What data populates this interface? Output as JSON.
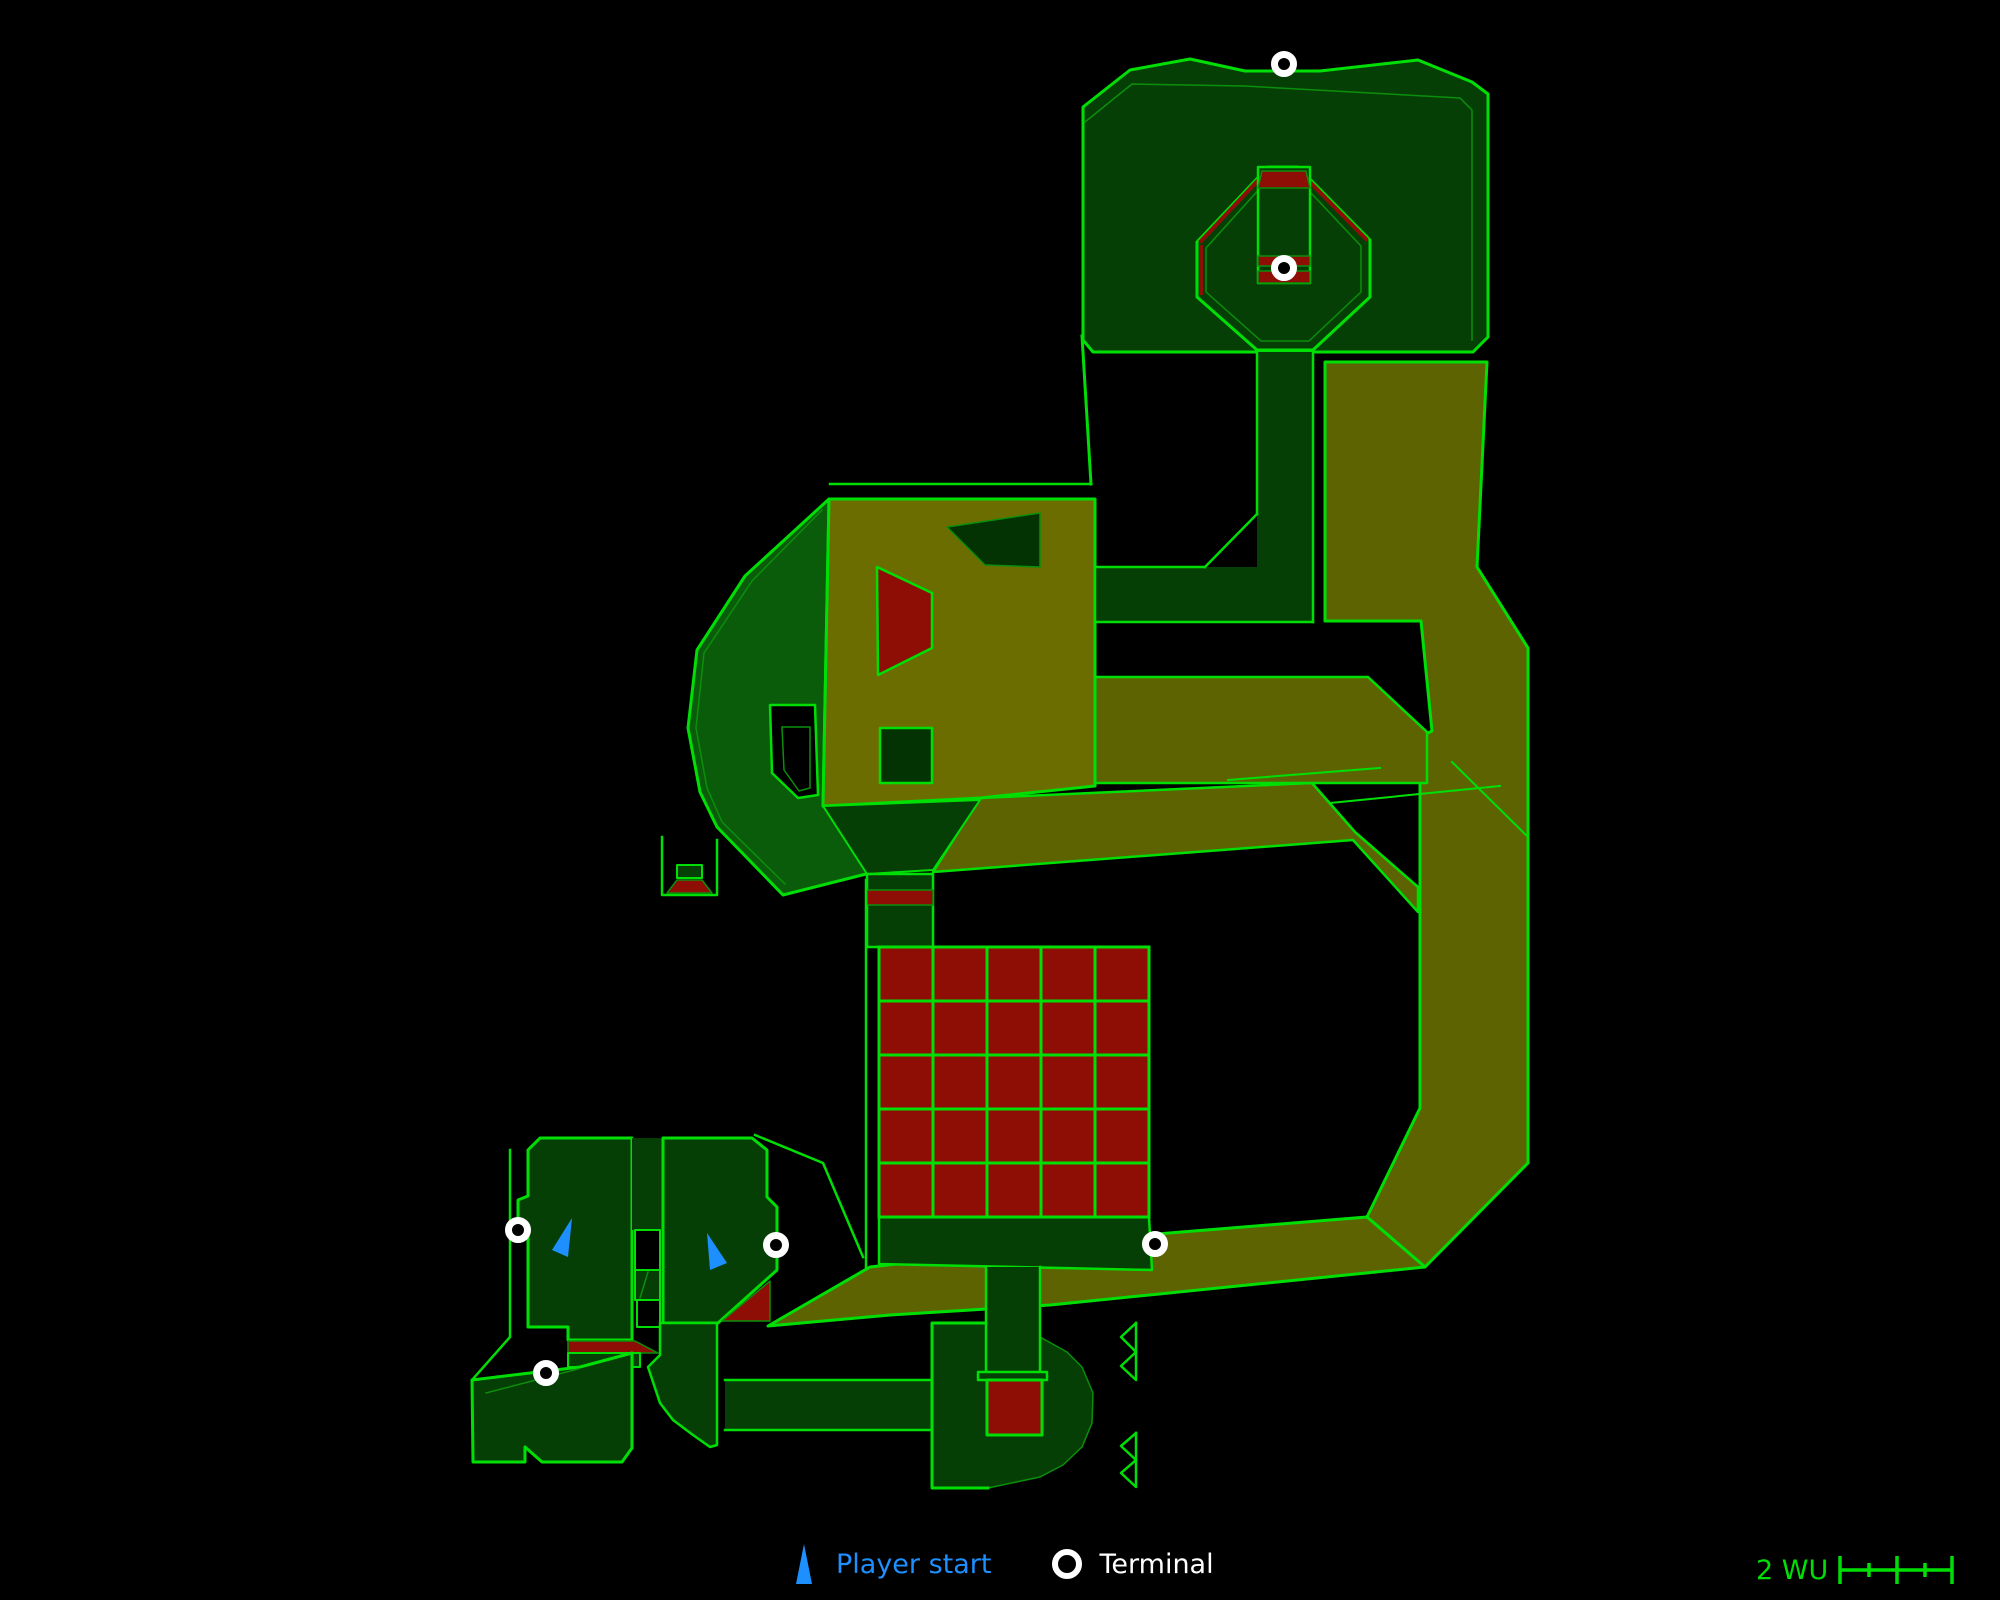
{
  "colors": {
    "background": "#000000",
    "bright": "#00df05",
    "dim": "#0b8f0b",
    "dg": "#063f06",
    "dg2": "#033203",
    "hept": "#0a5c0a",
    "olive": "#6c6d00",
    "olive2": "#5d6300",
    "red": "#8e0e06",
    "player": "#1e8fff",
    "terminal_ring": "#ffffff"
  },
  "legend": {
    "player_start_label": "Player start",
    "terminal_label": "Terminal"
  },
  "scale_bar": {
    "label": "2 WU"
  },
  "map": {
    "width": 2000,
    "height": 1600,
    "shapes": [
      {
        "t": "p",
        "n": "top-block",
        "pts": "1083,107 1130,70 1190,59 1245,71 1320,71 1418,60 1472,82 1488,94 1488,337 1473,352 1093,352 1083,340",
        "f": "dg",
        "s": "bright",
        "w": 3
      },
      {
        "t": "l",
        "n": "top-block-inner-line",
        "pts": "1085,122 1132,84 1244,86 1460,98 1472,110 1472,340",
        "s": "dim",
        "w": 1.5
      },
      {
        "t": "p",
        "n": "right-corridor",
        "pts": "1325,362 1487,362 1477,567 1528,648 1528,1163 1425,1267 1367,1217 1420,1108 1420,737 1432,731 1421,621 1325,621",
        "f": "olive2",
        "s": "bright",
        "w": 3
      },
      {
        "t": "p",
        "n": "lower-diagonal-corridor",
        "pts": "870,1267 1157,1234 1367,1217 1425,1267 1050,1305 890,1315 768,1326",
        "f": "olive2",
        "s": "bright",
        "w": 3
      },
      {
        "t": "p",
        "n": "upper-link-corridor",
        "pts": "980,798 1312,783 1355,832 1418,887 1418,912 1353,840 933,872",
        "f": "olive2",
        "s": "bright",
        "w": 2.5
      },
      {
        "t": "p",
        "n": "east-corridor-fill",
        "pts": "1095,677 1368,677 1427,732 1427,783 1095,783",
        "f": "olive2"
      },
      {
        "t": "l",
        "n": "east-corridor-edges",
        "pts": "1095,677 1368,677 1427,732 1427,783 1095,783",
        "s": "bright",
        "w": 2.5
      },
      {
        "t": "p",
        "n": "heptagon-room",
        "pts": "829,499 745,576 697,650 688,728 700,792 717,827 783,895 870,873 870,806 823,806",
        "f": "hept",
        "s": "bright",
        "w": 3
      },
      {
        "t": "l",
        "n": "heptagon-inner-line",
        "pts": "822,510 752,581 704,653 696,728 707,788 722,822 785,884",
        "s": "dim",
        "w": 1.5
      },
      {
        "t": "p",
        "n": "big-olive-room",
        "pts": "829,499 1095,499 1095,786 980,798 823,806",
        "f": "olive",
        "s": "bright",
        "w": 3
      },
      {
        "t": "p",
        "n": "room-south-wedge",
        "pts": "823,806 980,800 933,870 867,874",
        "f": "dg",
        "s": "bright",
        "w": 2
      },
      {
        "t": "p",
        "n": "room-dark-quad",
        "pts": "947,527 1040,513 1040,567 985,565",
        "f": "dg2",
        "s": "dim",
        "w": 1.5
      },
      {
        "t": "p",
        "n": "room-red-quad",
        "pts": "877,567 932,593 932,648 878,675",
        "f": "red",
        "s": "bright",
        "w": 2.5
      },
      {
        "t": "p",
        "n": "room-dark-square",
        "pts": "880,728 932,728 932,783 880,783",
        "f": "dg2",
        "s": "bright",
        "w": 2.5
      },
      {
        "t": "p",
        "n": "neck-fill",
        "pts": "1257,352 1313,352 1313,622 1257,622",
        "f": "dg"
      },
      {
        "t": "p",
        "n": "cross-strip-fill",
        "pts": "1095,567 1313,567 1313,622 1095,622",
        "f": "dg"
      },
      {
        "t": "l",
        "n": "neck-left-wall",
        "pts": "1257,352 1257,514",
        "s": "bright",
        "w": 2.5
      },
      {
        "t": "l",
        "n": "neck-diag-wall",
        "pts": "1257,514 1205,567",
        "s": "bright",
        "w": 2.5
      },
      {
        "t": "l",
        "n": "strip-top-edge",
        "pts": "1095,567 1205,567",
        "s": "bright",
        "w": 2.5
      },
      {
        "t": "l",
        "n": "strip-bottom-edge",
        "pts": "1095,622 1313,622",
        "s": "bright",
        "w": 2.5
      },
      {
        "t": "l",
        "n": "strip-left-edge",
        "pts": "1095,567 1095,622",
        "s": "bright",
        "w": 2.5
      },
      {
        "t": "l",
        "n": "neck-right-wall",
        "pts": "1313,352 1313,622",
        "s": "bright",
        "w": 2.5
      },
      {
        "t": "l",
        "n": "leg-slant-wall",
        "pts": "1082,336 1091,484",
        "s": "bright",
        "w": 3
      },
      {
        "t": "l",
        "n": "room-top-outer-line",
        "pts": "830,484 1091,484",
        "s": "bright",
        "w": 2.5
      },
      {
        "t": "p",
        "n": "octagon",
        "pts": "1268,167 1298,167 1370,240 1370,297 1313,350 1257,350 1197,297 1197,242",
        "f": "dg",
        "s": "bright",
        "w": 3
      },
      {
        "t": "l",
        "n": "octagon-inner-line",
        "pts": "1271,176 1295,176 1361,246 1361,292 1309,341 1261,341 1206,292 1206,248 1271,176",
        "s": "dim",
        "w": 1.5
      },
      {
        "t": "l",
        "n": "octagon-red-nw",
        "pts": "1264,174 1201,241",
        "s": "red",
        "w": 4
      },
      {
        "t": "l",
        "n": "octagon-red-w",
        "pts": "1201,247 1201,293",
        "s": "red",
        "w": 4
      },
      {
        "t": "l",
        "n": "octagon-red-ne",
        "pts": "1302,174 1366,239",
        "s": "red",
        "w": 4
      },
      {
        "t": "p",
        "n": "octagon-shaft",
        "pts": "1258,167 1310,167 1310,283 1258,283",
        "f": "dg",
        "s": "bright",
        "w": 2.5
      },
      {
        "t": "p",
        "n": "shaft-red-top",
        "pts": "1262,171 1306,171 1310,188 1258,188",
        "f": "red",
        "s": "dim",
        "w": 1.5
      },
      {
        "t": "p",
        "n": "shaft-red-band1",
        "pts": "1258,256 1310,256 1310,266 1258,266",
        "f": "red",
        "s": "dim",
        "w": 1.5
      },
      {
        "t": "p",
        "n": "shaft-red-band2",
        "pts": "1258,271 1310,271 1310,283 1258,283",
        "f": "red",
        "s": "dim",
        "w": 1.5
      },
      {
        "t": "l",
        "n": "cross-line-a",
        "pts": "1228,780 1380,768",
        "s": "bright",
        "w": 2
      },
      {
        "t": "l",
        "n": "cross-line-b",
        "pts": "1452,762 1528,837",
        "s": "bright",
        "w": 2
      },
      {
        "t": "l",
        "n": "cross-line-c",
        "pts": "1330,803 1500,786",
        "s": "bright",
        "w": 2
      },
      {
        "t": "p",
        "n": "plug-box",
        "pts": "677,865 702,865 702,878 677,878",
        "f": "dg",
        "s": "bright",
        "w": 2
      },
      {
        "t": "p",
        "n": "plug-red",
        "pts": "677,880 702,880 712,893 667,893",
        "f": "red",
        "s": "dim",
        "w": 1.5
      },
      {
        "t": "l",
        "n": "plug-walls",
        "pts": "662,837 662,895 717,895 717,840",
        "s": "bright",
        "w": 2.5
      },
      {
        "t": "p",
        "n": "d-ring",
        "pts": "770,705 815,705 818,795 798,798 772,773",
        "f": "background",
        "s": "bright",
        "w": 2.5
      },
      {
        "t": "l",
        "n": "d-ring-inner",
        "pts": "782,727 810,727 810,788 799,791 784,770 782,727",
        "s": "dim",
        "w": 1.5
      },
      {
        "t": "p",
        "n": "south-shaft",
        "pts": "867,874 933,874 933,947 867,947",
        "f": "dg",
        "s": "bright",
        "w": 2.5
      },
      {
        "t": "p",
        "n": "south-shaft-red",
        "pts": "867,890 933,890 933,905 867,905",
        "f": "red",
        "s": "dim",
        "w": 1.5
      },
      {
        "t": "l",
        "n": "grid-room-west-wall",
        "pts": "866,880 866,1267",
        "s": "bright",
        "w": 2.5
      },
      {
        "t": "p",
        "n": "grid-bottom-strip",
        "pts": "879,1217 1149,1217 1152,1270 879,1264",
        "f": "dg",
        "s": "bright",
        "w": 2.5
      },
      {
        "t": "l",
        "n": "southwest-long-wall",
        "pts": "755,1135 823,1163 863,1257",
        "s": "bright",
        "w": 2.5
      },
      {
        "t": "l",
        "n": "west-outer-wall",
        "pts": "510,1150 510,1337 472,1380",
        "s": "bright",
        "w": 2.5
      },
      {
        "t": "p",
        "n": "left-room",
        "pts": "540,1138 632,1138 632,1340 568,1340 568,1327 528,1327 528,1232 518,1228 518,1200 528,1196 528,1150",
        "f": "dg",
        "s": "bright",
        "w": 3
      },
      {
        "t": "p",
        "n": "divider-top",
        "pts": "632,1138 663,1138 663,1230 632,1230",
        "f": "dg"
      },
      {
        "t": "p",
        "n": "divider-gap1",
        "pts": "635,1230 660,1230 660,1270 635,1270",
        "f": "background",
        "s": "bright",
        "w": 2
      },
      {
        "t": "p",
        "n": "divider-door",
        "pts": "635,1270 660,1270 660,1300 635,1300",
        "f": "dg",
        "s": "bright",
        "w": 2
      },
      {
        "t": "l",
        "n": "divider-door-diag",
        "pts": "648,1272 640,1298",
        "s": "dim",
        "w": 1.5
      },
      {
        "t": "p",
        "n": "divider-gap2",
        "pts": "637,1300 660,1300 660,1327 637,1327",
        "f": "background",
        "s": "bright",
        "w": 2
      },
      {
        "t": "p",
        "n": "right-room",
        "pts": "663,1138 752,1138 767,1150 767,1197 777,1207 777,1270 718,1323 663,1323",
        "f": "dg",
        "s": "bright",
        "w": 3
      },
      {
        "t": "p",
        "n": "right-room-red-tri",
        "pts": "722,1321 770,1281 770,1321",
        "f": "red",
        "s": "dim",
        "w": 1.5
      },
      {
        "t": "p",
        "n": "left-red-band",
        "pts": "568,1341 635,1341 658,1353 568,1353",
        "f": "red",
        "s": "dim",
        "w": 1.5
      },
      {
        "t": "p",
        "n": "left-band-under",
        "pts": "568,1353 640,1353 640,1367 568,1367",
        "f": "dg",
        "s": "bright",
        "w": 2
      },
      {
        "t": "p",
        "n": "bottom-left-room",
        "pts": "472,1380 580,1367 632,1353 632,1448 622,1462 542,1462 525,1447 525,1462 473,1462",
        "f": "dg",
        "s": "bright",
        "w": 3
      },
      {
        "t": "l",
        "n": "bottom-left-room-diag",
        "pts": "486,1393 578,1369",
        "s": "dim",
        "w": 1.5
      },
      {
        "t": "p",
        "n": "pipe-bend",
        "pts": "660,1323 717,1323 717,1445 710,1447 693,1435 673,1420 660,1403 648,1367 660,1355",
        "f": "dg",
        "s": "bright",
        "w": 2.5
      },
      {
        "t": "p",
        "n": "south-corridor-fill",
        "pts": "725,1380 932,1380 932,1430 725,1430",
        "f": "dg"
      },
      {
        "t": "l",
        "n": "south-corridor-top",
        "pts": "725,1380 932,1380",
        "s": "bright",
        "w": 2.5
      },
      {
        "t": "l",
        "n": "south-corridor-bottom",
        "pts": "725,1430 932,1430",
        "s": "bright",
        "w": 2.5
      },
      {
        "t": "p",
        "n": "bottom-mid-room",
        "pts": "932,1323 987,1323 1040,1337 1067,1352 1082,1367 1093,1393 1092,1423 1082,1447 1063,1465 1040,1477 988,1488 932,1488",
        "f": "dg",
        "s": "dim",
        "w": 1.5
      },
      {
        "t": "l",
        "n": "bottom-mid-room-bright-edges",
        "pts": "987,1323 932,1323 932,1488 988,1488",
        "s": "bright",
        "w": 3
      },
      {
        "t": "p",
        "n": "mid-vert-corridor-fill",
        "pts": "986,1267 1040,1267 1040,1377 986,1377",
        "f": "dg"
      },
      {
        "t": "l",
        "n": "mid-vert-corridor-left",
        "pts": "986,1267 986,1377",
        "s": "bright",
        "w": 2.5
      },
      {
        "t": "l",
        "n": "mid-vert-corridor-right",
        "pts": "1040,1267 1040,1377",
        "s": "bright",
        "w": 2.5
      },
      {
        "t": "p",
        "n": "corridor-crossbar",
        "pts": "978,1372 1047,1372 1047,1380 978,1380",
        "f": "dg",
        "s": "bright",
        "w": 2.5
      },
      {
        "t": "p",
        "n": "bottom-red-square",
        "pts": "987,1380 1042,1380 1042,1435 987,1435",
        "f": "red",
        "s": "bright",
        "w": 3
      },
      {
        "t": "l",
        "n": "ledge-marker-1a",
        "pts": "1136,1323 1136,1352 1121,1337 1136,1323",
        "s": "bright",
        "w": 2.5
      },
      {
        "t": "l",
        "n": "ledge-marker-1b",
        "pts": "1136,1352 1136,1380 1121,1366 1136,1352",
        "s": "bright",
        "w": 2.5
      },
      {
        "t": "l",
        "n": "ledge-marker-2a",
        "pts": "1136,1433 1136,1460 1121,1446 1136,1433",
        "s": "bright",
        "w": 2.5
      },
      {
        "t": "l",
        "n": "ledge-marker-2b",
        "pts": "1136,1460 1136,1487 1121,1473 1136,1460",
        "s": "bright",
        "w": 2.5
      }
    ],
    "grid": {
      "x": 879,
      "y": 947,
      "cell": 54,
      "cols": 5,
      "rows": 5,
      "fill": "red",
      "stroke": "bright"
    },
    "terminals": [
      [
        1284,
        64
      ],
      [
        1284,
        268
      ],
      [
        518,
        1230
      ],
      [
        776,
        1245
      ],
      [
        546,
        1373
      ],
      [
        1155,
        1244
      ]
    ],
    "player_starts": [
      "572,1218 552,1250 568,1257",
      "707,1233 710,1270 727,1263"
    ]
  }
}
